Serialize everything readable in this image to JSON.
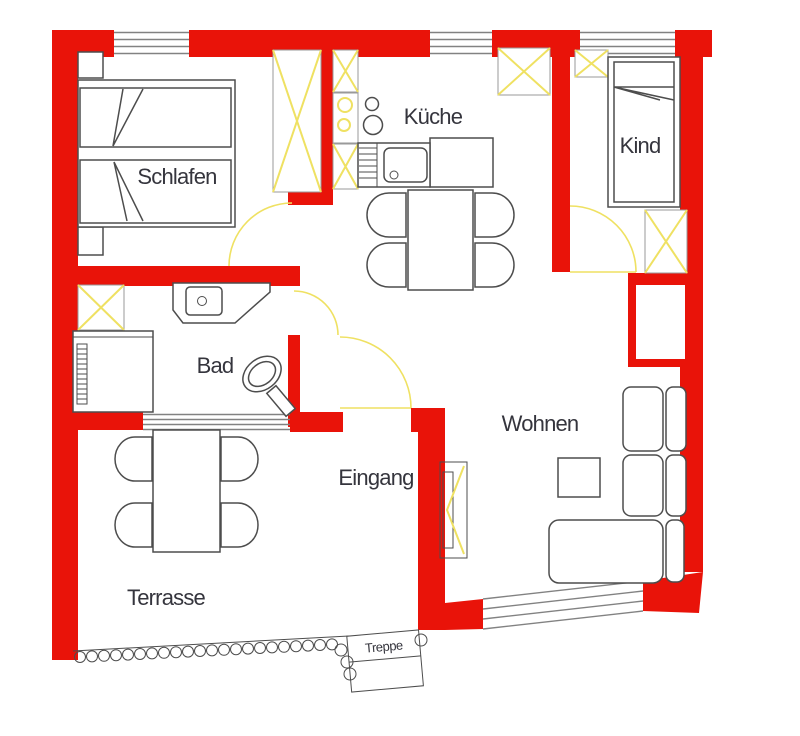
{
  "title": "Apartment floor plan",
  "rooms": {
    "schlafen": {
      "label": "Schlafen"
    },
    "kueche": {
      "label": "Küche"
    },
    "kind": {
      "label": "Kind"
    },
    "bad": {
      "label": "Bad"
    },
    "eingang": {
      "label": "Eingang"
    },
    "wohnen": {
      "label": "Wohnen"
    },
    "terrasse": {
      "label": "Terrasse"
    },
    "treppe": {
      "label": "Treppe"
    }
  },
  "colors": {
    "wall": "#e91309",
    "fixture_yellow": "#efe162",
    "furniture_line": "#4d4d4d",
    "window_line": "#828282",
    "label_text": "#35353d",
    "background": "#ffffff"
  }
}
